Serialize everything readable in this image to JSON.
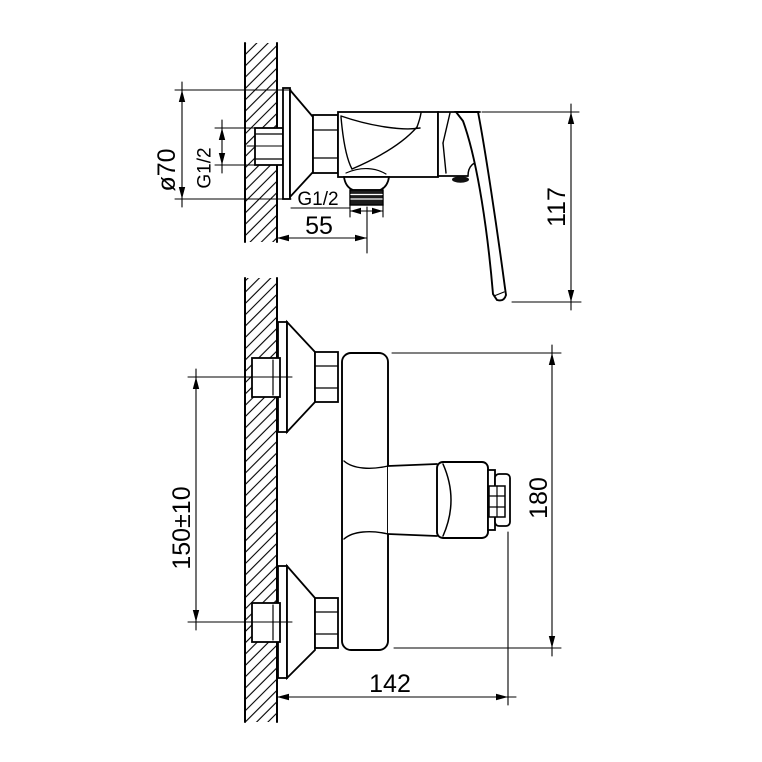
{
  "colors": {
    "background": "#ffffff",
    "line": "#000000"
  },
  "views": {
    "side": {
      "dims": {
        "flange_diameter": "ø70",
        "inlet_thread": "G1/2",
        "outlet_thread": "G1/2",
        "outlet_offset": "55",
        "height": "117"
      }
    },
    "front": {
      "dims": {
        "inlet_spacing": "150±10",
        "height": "180",
        "depth": "142"
      }
    }
  }
}
